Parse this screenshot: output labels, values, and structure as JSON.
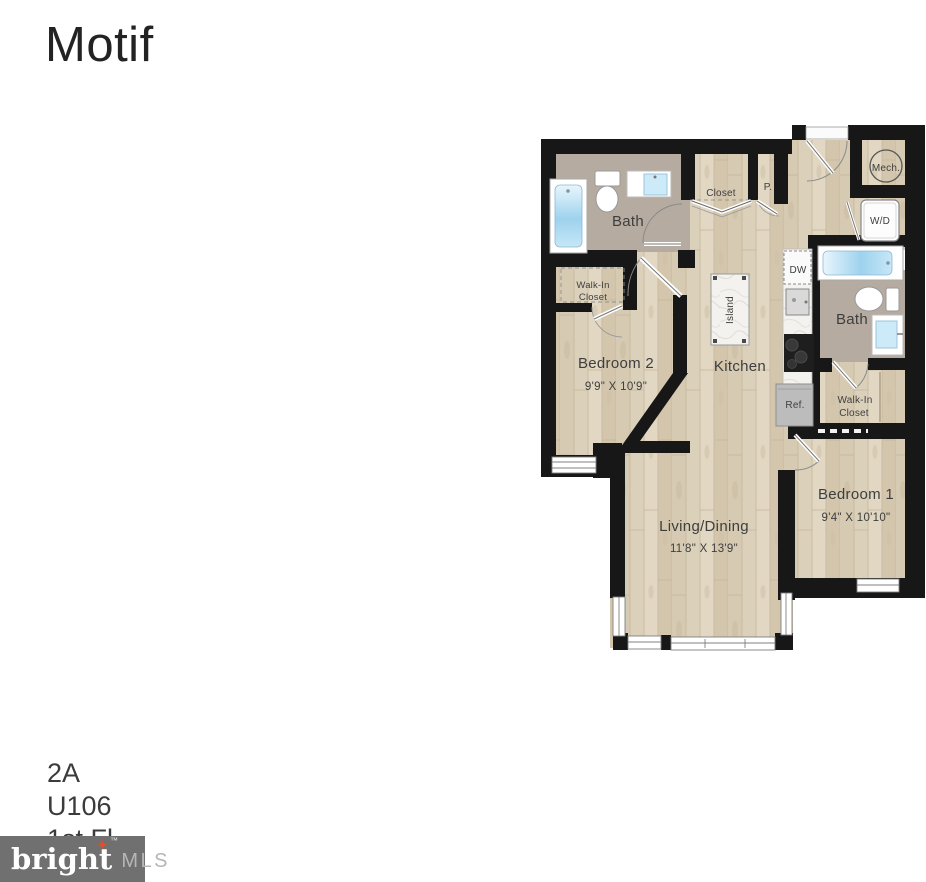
{
  "page": {
    "title": "Motif",
    "unit": {
      "plan": "2A",
      "number": "U106",
      "floor": "1st Fl"
    },
    "logo": {
      "brand": "bright",
      "star_glyph": "✦",
      "tm": "™",
      "suffix": "MLS",
      "bg_color": "#707070",
      "star_color": "#dd4f2e",
      "brand_color": "#ffffff",
      "suffix_color": "#b6b6b6"
    }
  },
  "plan": {
    "colors": {
      "wall": "#171717",
      "wood_floor": "#dbd0ba",
      "bath_floor": "#b5aba0",
      "tub_water": "#9ed2ee",
      "fixture_white": "#ffffff",
      "appliance_gray": "#bcbcbc",
      "stove_black": "#1e1e1e",
      "label_text": "#3e3e3e"
    },
    "rooms": {
      "bath_top": {
        "label": "Bath"
      },
      "closet": {
        "label": "Closet"
      },
      "pantry": {
        "label": "P."
      },
      "mech": {
        "label": "Mech."
      },
      "laundry": {
        "label": "W/D"
      },
      "walkin_left": {
        "line1": "Walk-In",
        "line2": "Closet"
      },
      "bedroom2": {
        "label": "Bedroom 2",
        "dims": "9'9\" X 10'9\""
      },
      "kitchen": {
        "label": "Kitchen"
      },
      "island": {
        "label": "Island"
      },
      "dishwasher": {
        "label": "DW"
      },
      "refrigerator": {
        "label": "Ref."
      },
      "bath_right": {
        "label": "Bath"
      },
      "walkin_right": {
        "line1": "Walk-In",
        "line2": "Closet"
      },
      "bedroom1": {
        "label": "Bedroom 1",
        "dims": "9'4\" X 10'10\""
      },
      "living": {
        "label": "Living/Dining",
        "dims": "11'8\" X 13'9\""
      }
    }
  }
}
